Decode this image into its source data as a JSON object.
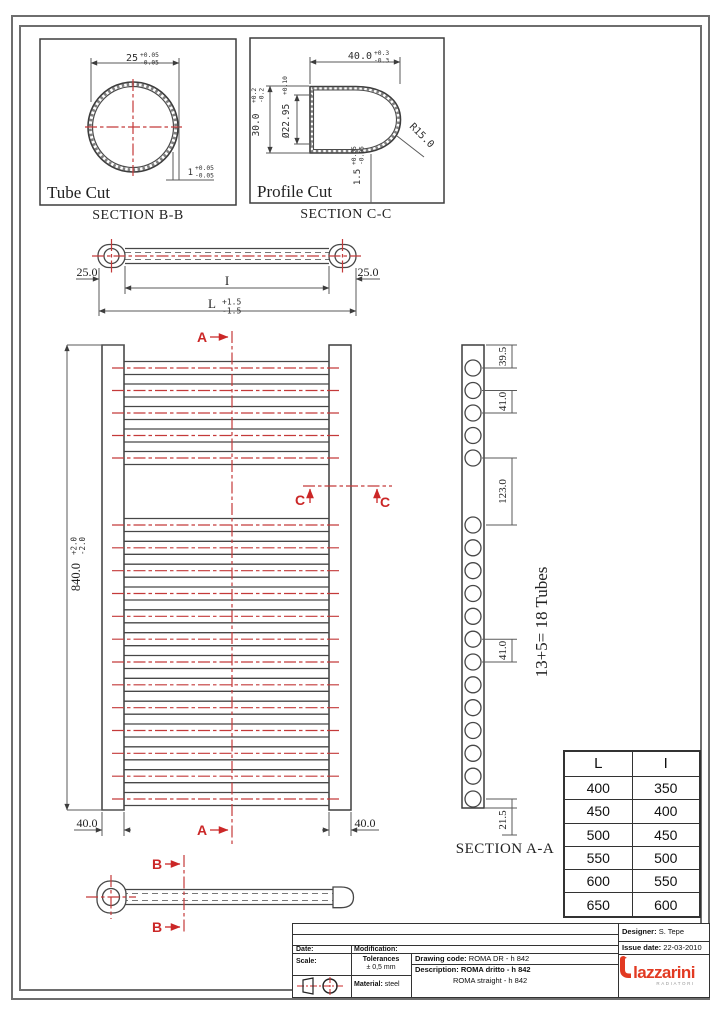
{
  "colors": {
    "red_centerline": "#c43a3a",
    "marker_red": "#cb2727",
    "line": "#3d3d3d",
    "logo_red": "#e23a22"
  },
  "detail_b": {
    "title": "Tube Cut",
    "section": "SECTION B-B",
    "od": {
      "v": "25",
      "p": "+0.05",
      "m": "-0.05"
    },
    "wall": {
      "v": "1",
      "p": "+0.05",
      "m": "-0.05"
    }
  },
  "detail_c": {
    "title": "Profile Cut",
    "section": "SECTION C-C",
    "w": {
      "v": "40.0",
      "p": "+0.3",
      "m": "-0.3"
    },
    "h": {
      "v": "30.0",
      "p": "+0.2",
      "m": "-0.2"
    },
    "id": {
      "v": "Ø22.95",
      "p": "+0.10"
    },
    "r": "R15.0",
    "wall": {
      "v": "1.5",
      "p": "+0.05",
      "m": "-0.05"
    }
  },
  "plan": {
    "left": "25.0",
    "right": "25.0",
    "inner": "I",
    "overall": {
      "v": "L",
      "p": "+1.5",
      "m": "-1.5"
    }
  },
  "front": {
    "height": {
      "v": "840.0",
      "p": "+2.0",
      "m": "-2.0"
    },
    "foot_left": "40.0",
    "foot_right": "40.0",
    "marker_a": "A",
    "marker_c": "C"
  },
  "side": {
    "marker_b": "B"
  },
  "section_a": {
    "title": "SECTION A-A",
    "note": "13+5= 18 Tubes",
    "top_count": 5,
    "bottom_count": 13,
    "dim_top": "39.5",
    "dim_pitch": "41.0",
    "dim_gap": "123.0",
    "dim_pitch2": "41.0",
    "dim_bottom": "21.5"
  },
  "table": {
    "headers": [
      "L",
      "I"
    ],
    "rows": [
      [
        "400",
        "350"
      ],
      [
        "450",
        "400"
      ],
      [
        "500",
        "450"
      ],
      [
        "550",
        "500"
      ],
      [
        "600",
        "550"
      ],
      [
        "650",
        "600"
      ]
    ]
  },
  "title_block": {
    "date": "Date:",
    "modification": "Modification:",
    "scale": "Scale:",
    "tol1": "Tolerances",
    "tol2": "± 0,5 mm",
    "material_label": "Material:",
    "material_value": "steel",
    "code_label": "Drawing code:",
    "code_value": "ROMA DR - h 842",
    "desc_label": "Description:",
    "desc_value": "ROMA dritto - h 842",
    "desc_value2": "ROMA straight - h 842",
    "designer_label": "Designer:",
    "designer_value": "S. Tepe",
    "issue_label": "Issue date:",
    "issue_value": "22-03-2010",
    "logo": "lazzarini",
    "logo_sub": "RADIATORI"
  }
}
